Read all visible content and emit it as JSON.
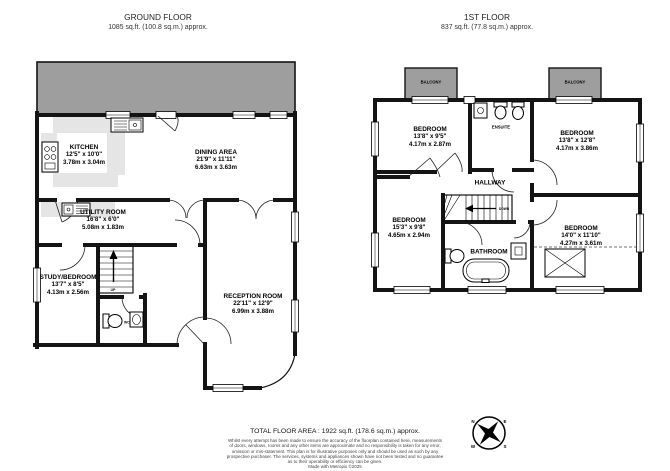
{
  "ground_floor": {
    "title": "GROUND FLOOR",
    "subtitle": "1085 sq.ft. (100.8 sq.m.) approx.",
    "rooms": {
      "kitchen": {
        "name": "KITCHEN",
        "size_ft": "12'5\" x 10'0\"",
        "size_m": "3.78m x 3.04m"
      },
      "dining": {
        "name": "DINING AREA",
        "size_ft": "21'9\" x 11'11\"",
        "size_m": "6.63m x 3.63m"
      },
      "utility": {
        "name": "UTILITY ROOM",
        "size_ft": "16'8\" x 6'0\"",
        "size_m": "5.08m x 1.83m"
      },
      "study": {
        "name": "STUDY/BEDROOM",
        "size_ft": "13'7\" x 8'5\"",
        "size_m": "4.13m x 2.56m"
      },
      "reception": {
        "name": "RECEPTION ROOM",
        "size_ft": "22'11\" x 12'9\"",
        "size_m": "6.99m x 3.88m"
      }
    },
    "annotations": {
      "up": "UP",
      "wc": "WC"
    }
  },
  "first_floor": {
    "title": "1ST FLOOR",
    "subtitle": "837 sq.ft. (77.8 sq.m.) approx.",
    "rooms": {
      "bedroom_front_left": {
        "name": "BEDROOM",
        "size_ft": "13'8\" x 9'5\"",
        "size_m": "4.17m x 2.87m"
      },
      "bedroom_front_right": {
        "name": "BEDROOM",
        "size_ft": "13'8\" x 12'8\"",
        "size_m": "4.17m x 3.86m"
      },
      "bedroom_back_left": {
        "name": "BEDROOM",
        "size_ft": "15'3\" x 9'8\"",
        "size_m": "4.65m x 2.94m"
      },
      "bedroom_back_right": {
        "name": "BEDROOM",
        "size_ft": "14'0\" x 11'10\"",
        "size_m": "4.27m x 3.61m"
      },
      "hallway": {
        "name": "HALLWAY"
      },
      "bathroom": {
        "name": "BATHROOM"
      },
      "ensuite": {
        "name": "ENSUITE"
      },
      "balcony_left": {
        "name": "BALCONY"
      },
      "balcony_right": {
        "name": "BALCONY"
      }
    },
    "annotations": {
      "down": "DOWN"
    }
  },
  "footer": {
    "total_area": "TOTAL FLOOR AREA : 1922 sq.ft. (178.6 sq.m.) approx.",
    "disclaimer_lines": [
      "Whilst every attempt has been made to ensure the accuracy of the floorplan contained here, measurements",
      "of doors, windows, rooms and any other items are approximate and no responsibility is taken for any error,",
      "omission or mis-statement. This plan is for illustrative purposes only and should be used as such by any",
      "prospective purchaser. The services, systems and appliances shown have not been tested and no guarantee",
      "as to their operability or efficiency can be given."
    ],
    "credit": "Made with Metropix ©2025"
  },
  "compass": {
    "north": "N",
    "east": "E",
    "south": "S",
    "west": "W"
  },
  "colors": {
    "wall": "#141414",
    "deck": "#9e9e9e",
    "counter": "#e5e5e5"
  }
}
